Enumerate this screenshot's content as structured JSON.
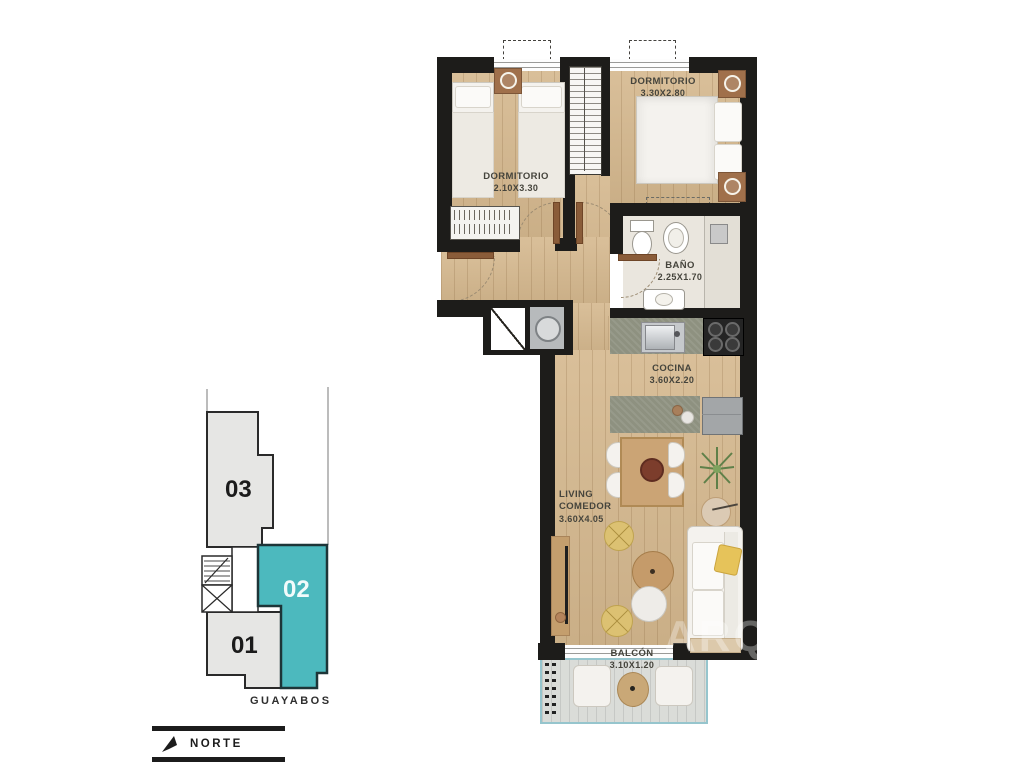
{
  "plan": {
    "rooms": [
      {
        "name": "DORMITORIO",
        "dims": "2.10x3.30"
      },
      {
        "name": "DORMITORIO",
        "dims": "3.30x2.80"
      },
      {
        "name": "BAÑO",
        "dims": "2.25x1.70"
      },
      {
        "name": "COCINA",
        "dims": "3.60x2.20"
      },
      {
        "name": "LIVING",
        "name2": "COMEDOR",
        "dims": "3.60x4.05"
      },
      {
        "name": "BALCÓN",
        "dims": "3.10x1.20"
      }
    ],
    "watermark": "ARQ"
  },
  "keyplan": {
    "units": [
      {
        "id": "03",
        "highlighted": false
      },
      {
        "id": "02",
        "highlighted": true
      },
      {
        "id": "01",
        "highlighted": false
      }
    ],
    "street": "GUAYABOS",
    "highlight_color": "#4cb9be",
    "unit_fill": "#e6e6e4"
  },
  "compass": {
    "label": "NORTE"
  },
  "colors": {
    "wall": "#1d1c1a",
    "wood": "#d4b78d",
    "accent": "#4cb9be",
    "deck_rail": "#96c5cd"
  }
}
